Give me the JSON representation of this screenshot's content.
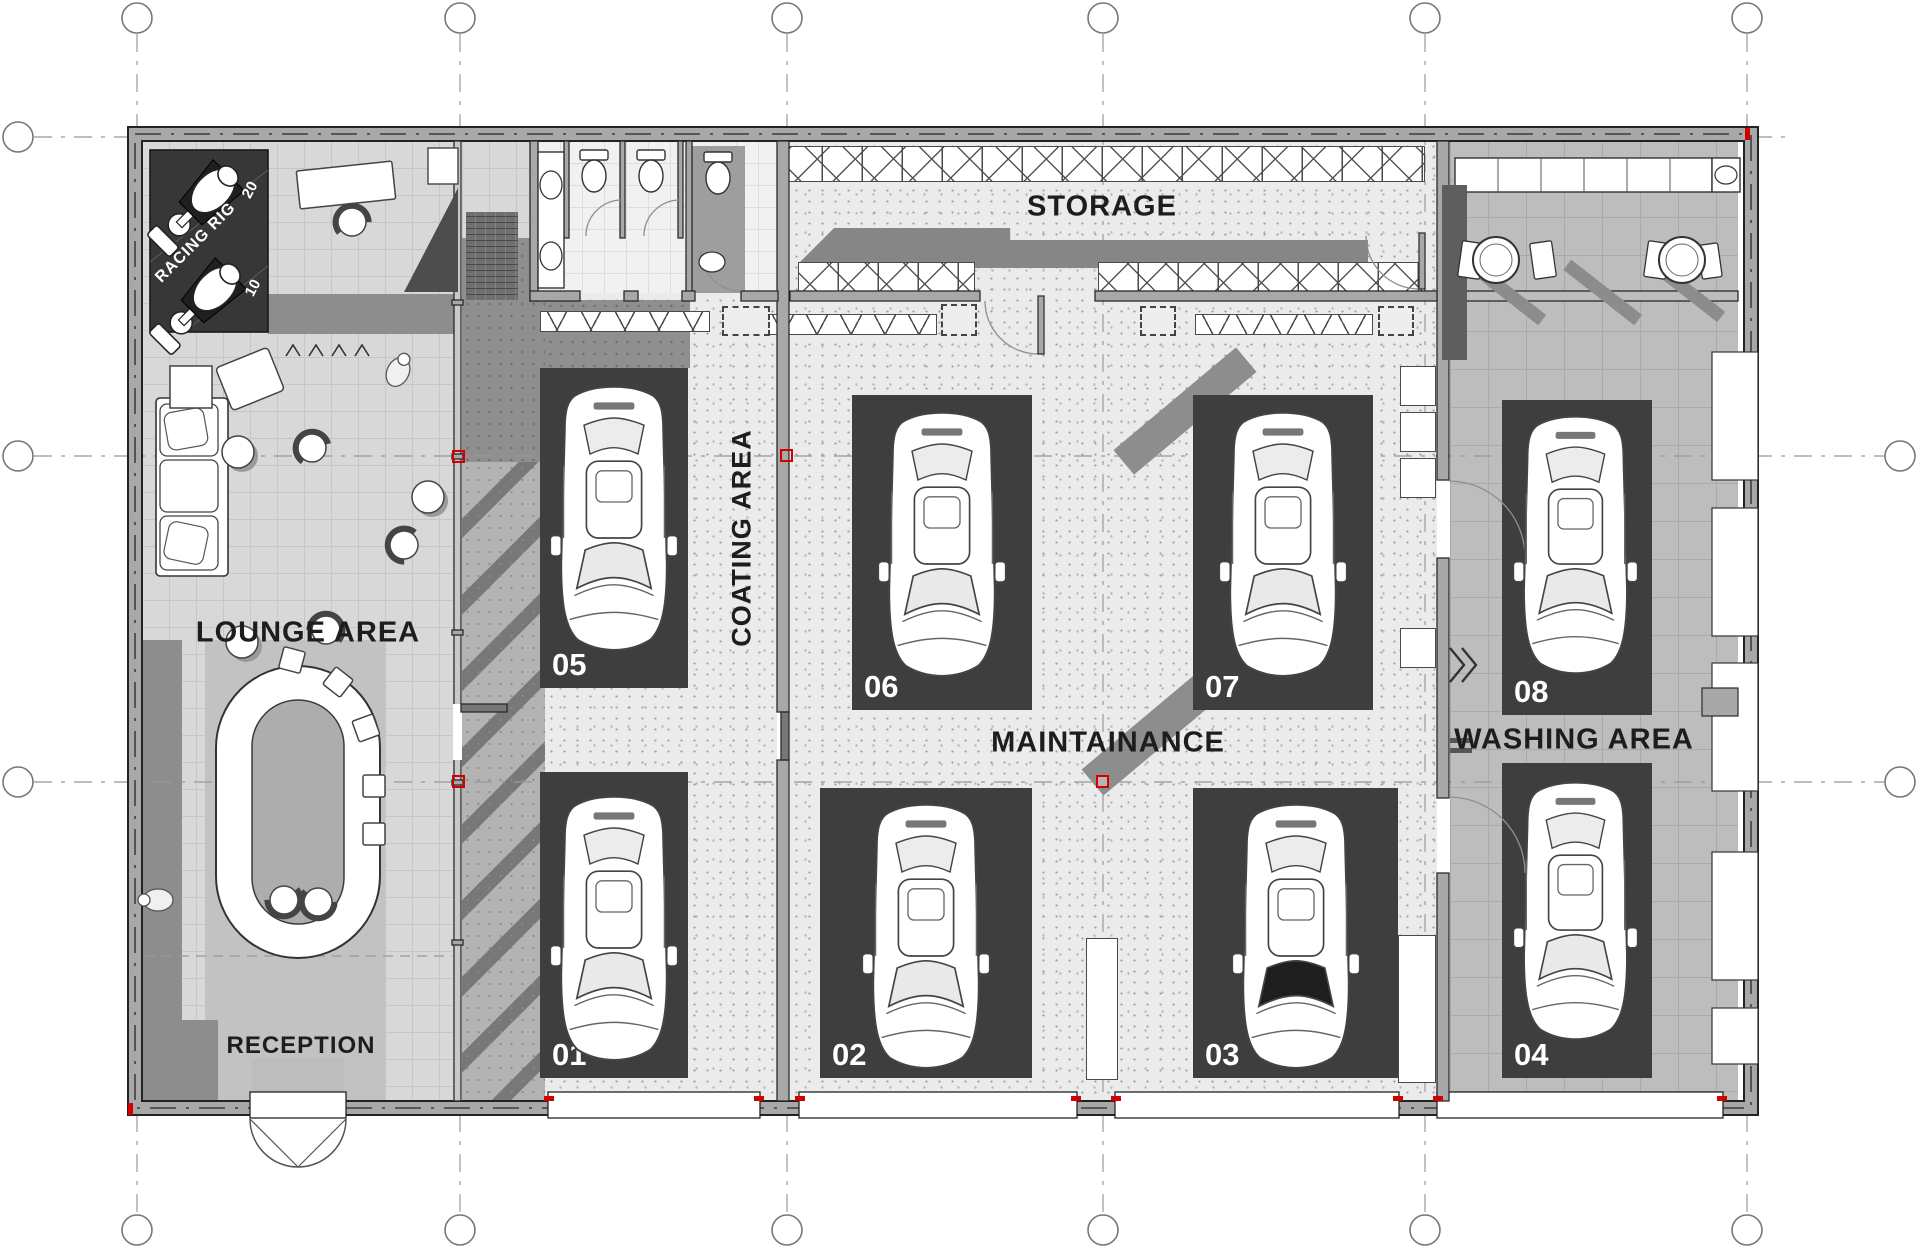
{
  "plan": {
    "zones": {
      "racing_rig": {
        "label": "RACING RIG",
        "count_top": "20",
        "count_bottom": "10"
      },
      "lounge": {
        "label": "LOUNGE AREA"
      },
      "reception": {
        "label": "RECEPTION"
      },
      "coating": {
        "label": "COATING AREA"
      },
      "storage": {
        "label": "STORAGE"
      },
      "maintenance": {
        "label": "MAINTAINANCE"
      },
      "washing": {
        "label": "WASHING AREA"
      }
    },
    "bays": [
      "01",
      "02",
      "03",
      "04",
      "05",
      "06",
      "07",
      "08"
    ],
    "colors": {
      "accent": "#d40000",
      "bay_pad": "#3e3e3e",
      "wall": "#a8a8a8",
      "dark_room": "#373737"
    }
  }
}
